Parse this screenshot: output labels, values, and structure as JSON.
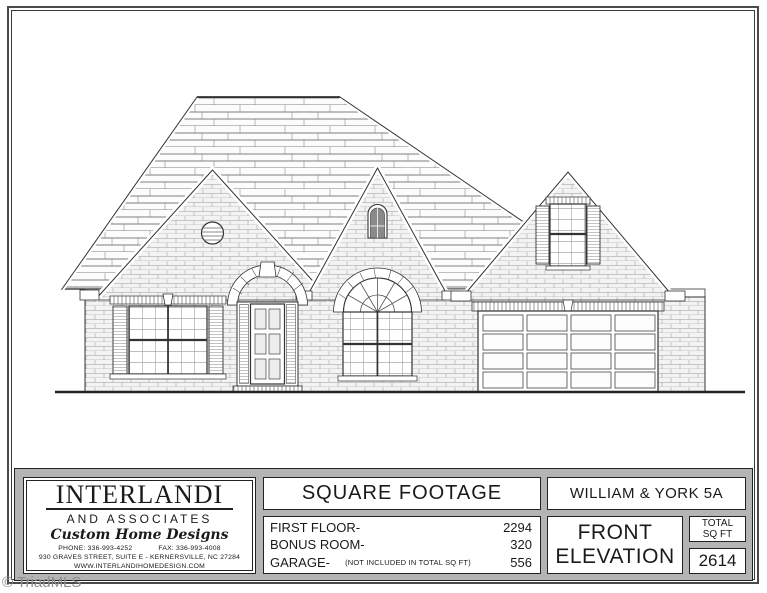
{
  "watermark": "© TriadMLS",
  "title_block": {
    "company": {
      "name": "INTERLANDI",
      "subname": "AND ASSOCIATES",
      "tagline": "Custom Home Designs",
      "phone": "PHONE: 336-993-4252",
      "fax": "FAX: 336-993-4008",
      "address": "930 GRAVES STREET,  SUITE E - KERNERSVILLE, NC 27284",
      "website": "WWW.INTERLANDIHOMEDESIGN.COM"
    },
    "square_footage": {
      "header": "SQUARE FOOTAGE",
      "rows": [
        {
          "label": "FIRST FLOOR-",
          "note": "",
          "value": "2294"
        },
        {
          "label": "BONUS ROOM-",
          "note": "",
          "value": "320"
        },
        {
          "label": "GARAGE-",
          "note": "(NOT INCLUDED IN TOTAL SQ FT)",
          "value": "556"
        }
      ]
    },
    "plan_name": "WILLIAM & YORK 5A",
    "view": {
      "line1": "FRONT",
      "line2": "ELEVATION"
    },
    "total": {
      "label_line1": "TOTAL",
      "label_line2": "SQ FT",
      "value": "2614"
    }
  },
  "colors": {
    "titleblock_bg": "#b4b4b4",
    "line": "#222222",
    "watermark": "#8f8f8f"
  }
}
